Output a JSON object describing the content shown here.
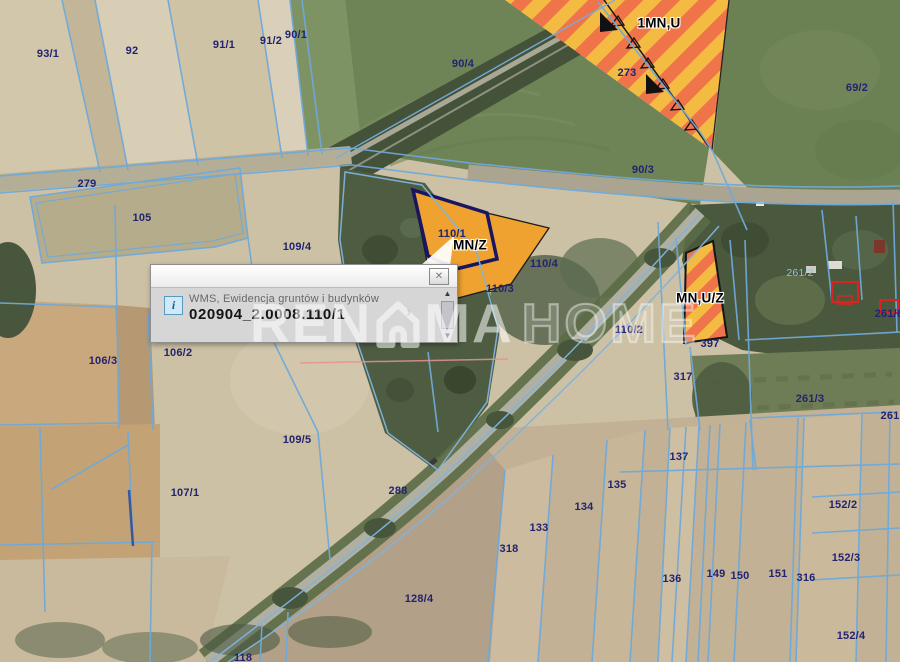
{
  "watermark": {
    "part1": "REN",
    "part2": "MA",
    "suffix": "HOME",
    "full": "RENOMA HOME"
  },
  "popup": {
    "source_label": "WMS, Ewidencja gruntów i budynków",
    "feature_id": "020904_2.0008.110/1",
    "close_icon": "✕",
    "info_icon_glyph": "i",
    "expand_icon": "›",
    "scroll_up_icon": "▲",
    "scroll_down_icon": "▼"
  },
  "map": {
    "colors": {
      "cadastral_line": "#6fa9da",
      "selection_outline": "#191563",
      "zone_stripe_orange": "#f0744a",
      "zone_stripe_yellow": "#f3bb41",
      "zone_solid_orange": "#efa22f",
      "parcel_label": "#232370",
      "building_outline": "#dd2222"
    },
    "labels": [
      {
        "text": "93/1",
        "x": 48,
        "y": 54,
        "cls": "parcel"
      },
      {
        "text": "92",
        "x": 132,
        "y": 51,
        "cls": "parcel"
      },
      {
        "text": "91/1",
        "x": 224,
        "y": 45,
        "cls": "parcel"
      },
      {
        "text": "91/2",
        "x": 271,
        "y": 41,
        "cls": "parcel"
      },
      {
        "text": "90/1",
        "x": 296,
        "y": 35,
        "cls": "parcel"
      },
      {
        "text": "90/4",
        "x": 463,
        "y": 64,
        "cls": "parcel"
      },
      {
        "text": "273",
        "x": 627,
        "y": 73,
        "cls": "parcel"
      },
      {
        "text": "69/2",
        "x": 857,
        "y": 88,
        "cls": "parcel"
      },
      {
        "text": "90/3",
        "x": 643,
        "y": 170,
        "cls": "parcel"
      },
      {
        "text": "279",
        "x": 87,
        "y": 184,
        "cls": "parcel"
      },
      {
        "text": "105",
        "x": 142,
        "y": 218,
        "cls": "parcel"
      },
      {
        "text": "109/4",
        "x": 297,
        "y": 247,
        "cls": "parcel"
      },
      {
        "text": "106/3",
        "x": 103,
        "y": 361,
        "cls": "parcel"
      },
      {
        "text": "106/2",
        "x": 178,
        "y": 353,
        "cls": "parcel"
      },
      {
        "text": "107/1",
        "x": 185,
        "y": 493,
        "cls": "parcel"
      },
      {
        "text": "109/5",
        "x": 297,
        "y": 440,
        "cls": "parcel"
      },
      {
        "text": "288",
        "x": 398,
        "y": 491,
        "cls": "parcel"
      },
      {
        "text": "128/4",
        "x": 419,
        "y": 599,
        "cls": "parcel"
      },
      {
        "text": "318",
        "x": 509,
        "y": 549,
        "cls": "parcel"
      },
      {
        "text": "118",
        "x": 243,
        "y": 658,
        "cls": "parcel"
      },
      {
        "text": "133",
        "x": 539,
        "y": 528,
        "cls": "parcel"
      },
      {
        "text": "134",
        "x": 584,
        "y": 507,
        "cls": "parcel"
      },
      {
        "text": "135",
        "x": 617,
        "y": 485,
        "cls": "parcel"
      },
      {
        "text": "137",
        "x": 679,
        "y": 457,
        "cls": "parcel"
      },
      {
        "text": "136",
        "x": 672,
        "y": 579,
        "cls": "parcel"
      },
      {
        "text": "149",
        "x": 716,
        "y": 574,
        "cls": "parcel"
      },
      {
        "text": "150",
        "x": 740,
        "y": 576,
        "cls": "parcel"
      },
      {
        "text": "151",
        "x": 778,
        "y": 574,
        "cls": "parcel"
      },
      {
        "text": "316",
        "x": 806,
        "y": 578,
        "cls": "parcel"
      },
      {
        "text": "152/2",
        "x": 843,
        "y": 505,
        "cls": "parcel"
      },
      {
        "text": "152/3",
        "x": 846,
        "y": 558,
        "cls": "parcel"
      },
      {
        "text": "152/4",
        "x": 851,
        "y": 636,
        "cls": "parcel"
      },
      {
        "text": "317",
        "x": 683,
        "y": 377,
        "cls": "parcel"
      },
      {
        "text": "397",
        "x": 710,
        "y": 344,
        "cls": "parcel"
      },
      {
        "text": "261/3",
        "x": 810,
        "y": 399,
        "cls": "parcel"
      },
      {
        "text": "261",
        "x": 890,
        "y": 416,
        "cls": "parcel"
      },
      {
        "text": "261/6",
        "x": 889,
        "y": 314,
        "cls": "parcel"
      },
      {
        "text": "261/2",
        "x": 800,
        "y": 273,
        "cls": "light"
      },
      {
        "text": "110/1",
        "x": 452,
        "y": 234,
        "cls": "parcel"
      },
      {
        "text": "110/4",
        "x": 544,
        "y": 264,
        "cls": "parcel"
      },
      {
        "text": "110/3",
        "x": 500,
        "y": 289,
        "cls": "parcel"
      },
      {
        "text": "110/2",
        "x": 629,
        "y": 330,
        "cls": "parcel"
      },
      {
        "text": "1MN,U",
        "x": 659,
        "y": 23,
        "cls": "zone"
      },
      {
        "text": "MN/Z",
        "x": 470,
        "y": 245,
        "cls": "zone"
      },
      {
        "text": "MN,U/Z",
        "x": 700,
        "y": 298,
        "cls": "zone"
      }
    ]
  }
}
